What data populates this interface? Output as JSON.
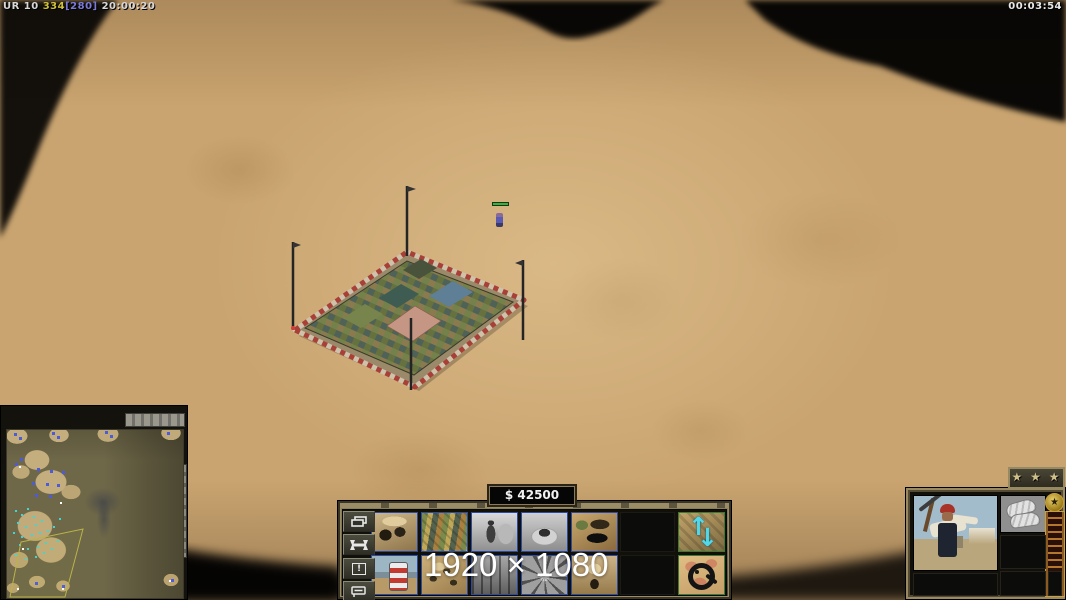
{
  "hud": {
    "stats": {
      "prefix": "UR 10 ",
      "supply": "334",
      "limit": "[280]",
      "session_time": " 20:00:20"
    },
    "match_clock": "00:03:54",
    "money": "$ 42500",
    "watermark": "1920 × 1080"
  },
  "command_bar": {
    "side_buttons": [
      {
        "name": "structures-tab-button",
        "icon": "windows"
      },
      {
        "name": "repair-button",
        "icon": "wrench"
      },
      {
        "name": "alert-button",
        "icon": "!"
      },
      {
        "name": "beacon-button",
        "icon": "beacon"
      }
    ],
    "rows": [
      {
        "slots": [
          "barracks",
          "supply-stash",
          "worker-gray",
          "tunnel-mound-gray",
          "black-market",
          "empty",
          "raise-lower-building"
        ]
      },
      {
        "slots": [
          "demo-barrel",
          "arms-yard",
          "interior-gray",
          "spoke-wheel-gray",
          "palace-dome",
          "empty",
          "mine-detector"
        ]
      }
    ],
    "arrow_up": "↑",
    "arrow_down": "↓"
  },
  "unit_panel": {
    "rank_stars": "★ ★ ★",
    "veterancy_star": "★"
  },
  "minimap": {
    "description": "desert map with supply areas, blue depots, cyan supplies, camera frustum"
  },
  "scene": {
    "selected_building": "supply-stash",
    "unit": "worker"
  },
  "colors": {
    "supply_yellow": "#cfc13a",
    "limit_blue": "#7a7ad8",
    "arrow_cyan": "#52d8ea",
    "health_green": "#3fae3f",
    "frame_tan": "#9a8a64",
    "money_text": "#f2f2f2"
  }
}
